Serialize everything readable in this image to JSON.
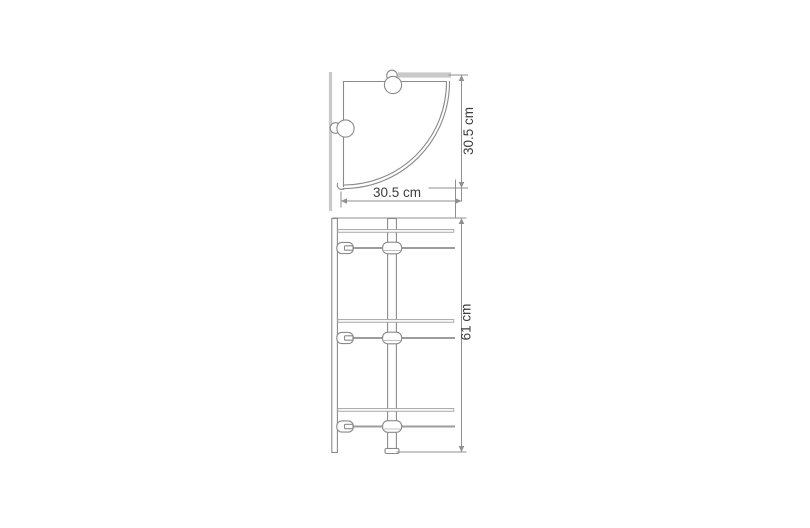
{
  "diagram": {
    "views": {
      "top": {
        "depth_label": "30.5 cm",
        "width_label": "30.5 cm"
      },
      "front": {
        "height_label": "61 cm",
        "tier_count": 3
      }
    },
    "colors": {
      "background": "#ffffff",
      "outline": "#8a8a8a",
      "glass_edge": "#a5a5a5",
      "wall": "#c9c9c9",
      "dimension": "#8f8f8f",
      "label_text": "#3d3d3d"
    }
  }
}
